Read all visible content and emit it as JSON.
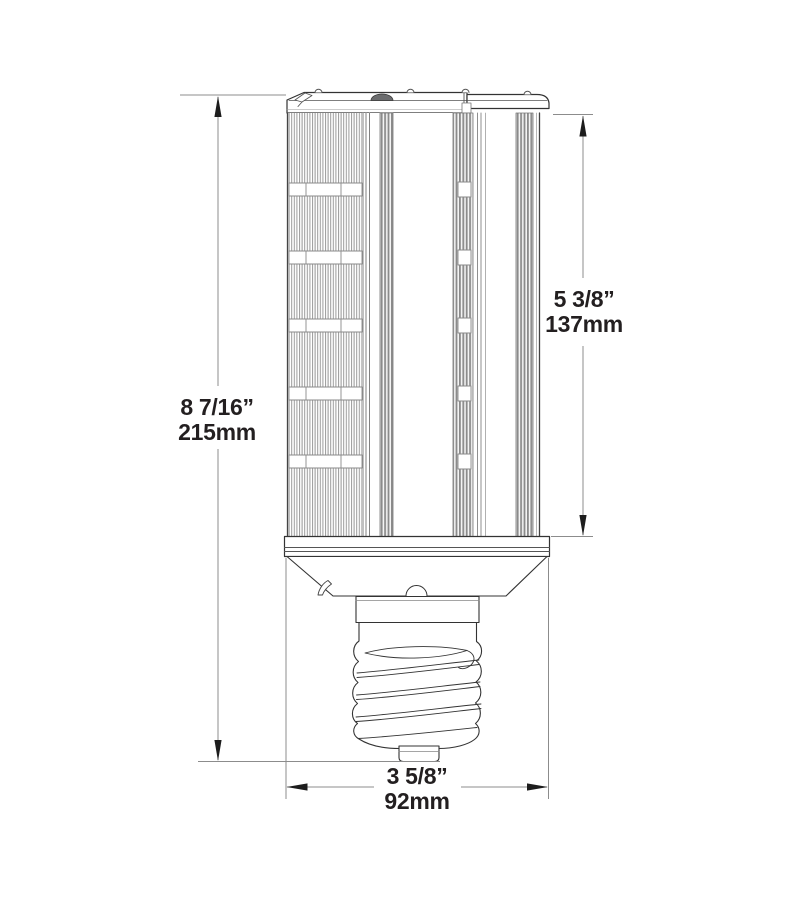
{
  "figure": {
    "type": "technical-dimension-drawing",
    "subject": "led-corn-lamp-with-mogul-screw-base",
    "colors": {
      "outline": "#333333",
      "dimension_line": "#8c8c8c",
      "arrow": "#1d1d1d",
      "text": "#231f20",
      "fin_shade": "#9a9a9a",
      "dome_fill": "#6b6c6e",
      "background": "#ffffff"
    },
    "dimensions": {
      "overall_height": {
        "label_in": "8 7/16”",
        "label_mm": "215mm"
      },
      "lamp_body_height": {
        "label_in": "5 3/8”",
        "label_mm": "137mm"
      },
      "base_width": {
        "label_in": "3 5/8”",
        "label_mm": "92mm"
      }
    }
  }
}
